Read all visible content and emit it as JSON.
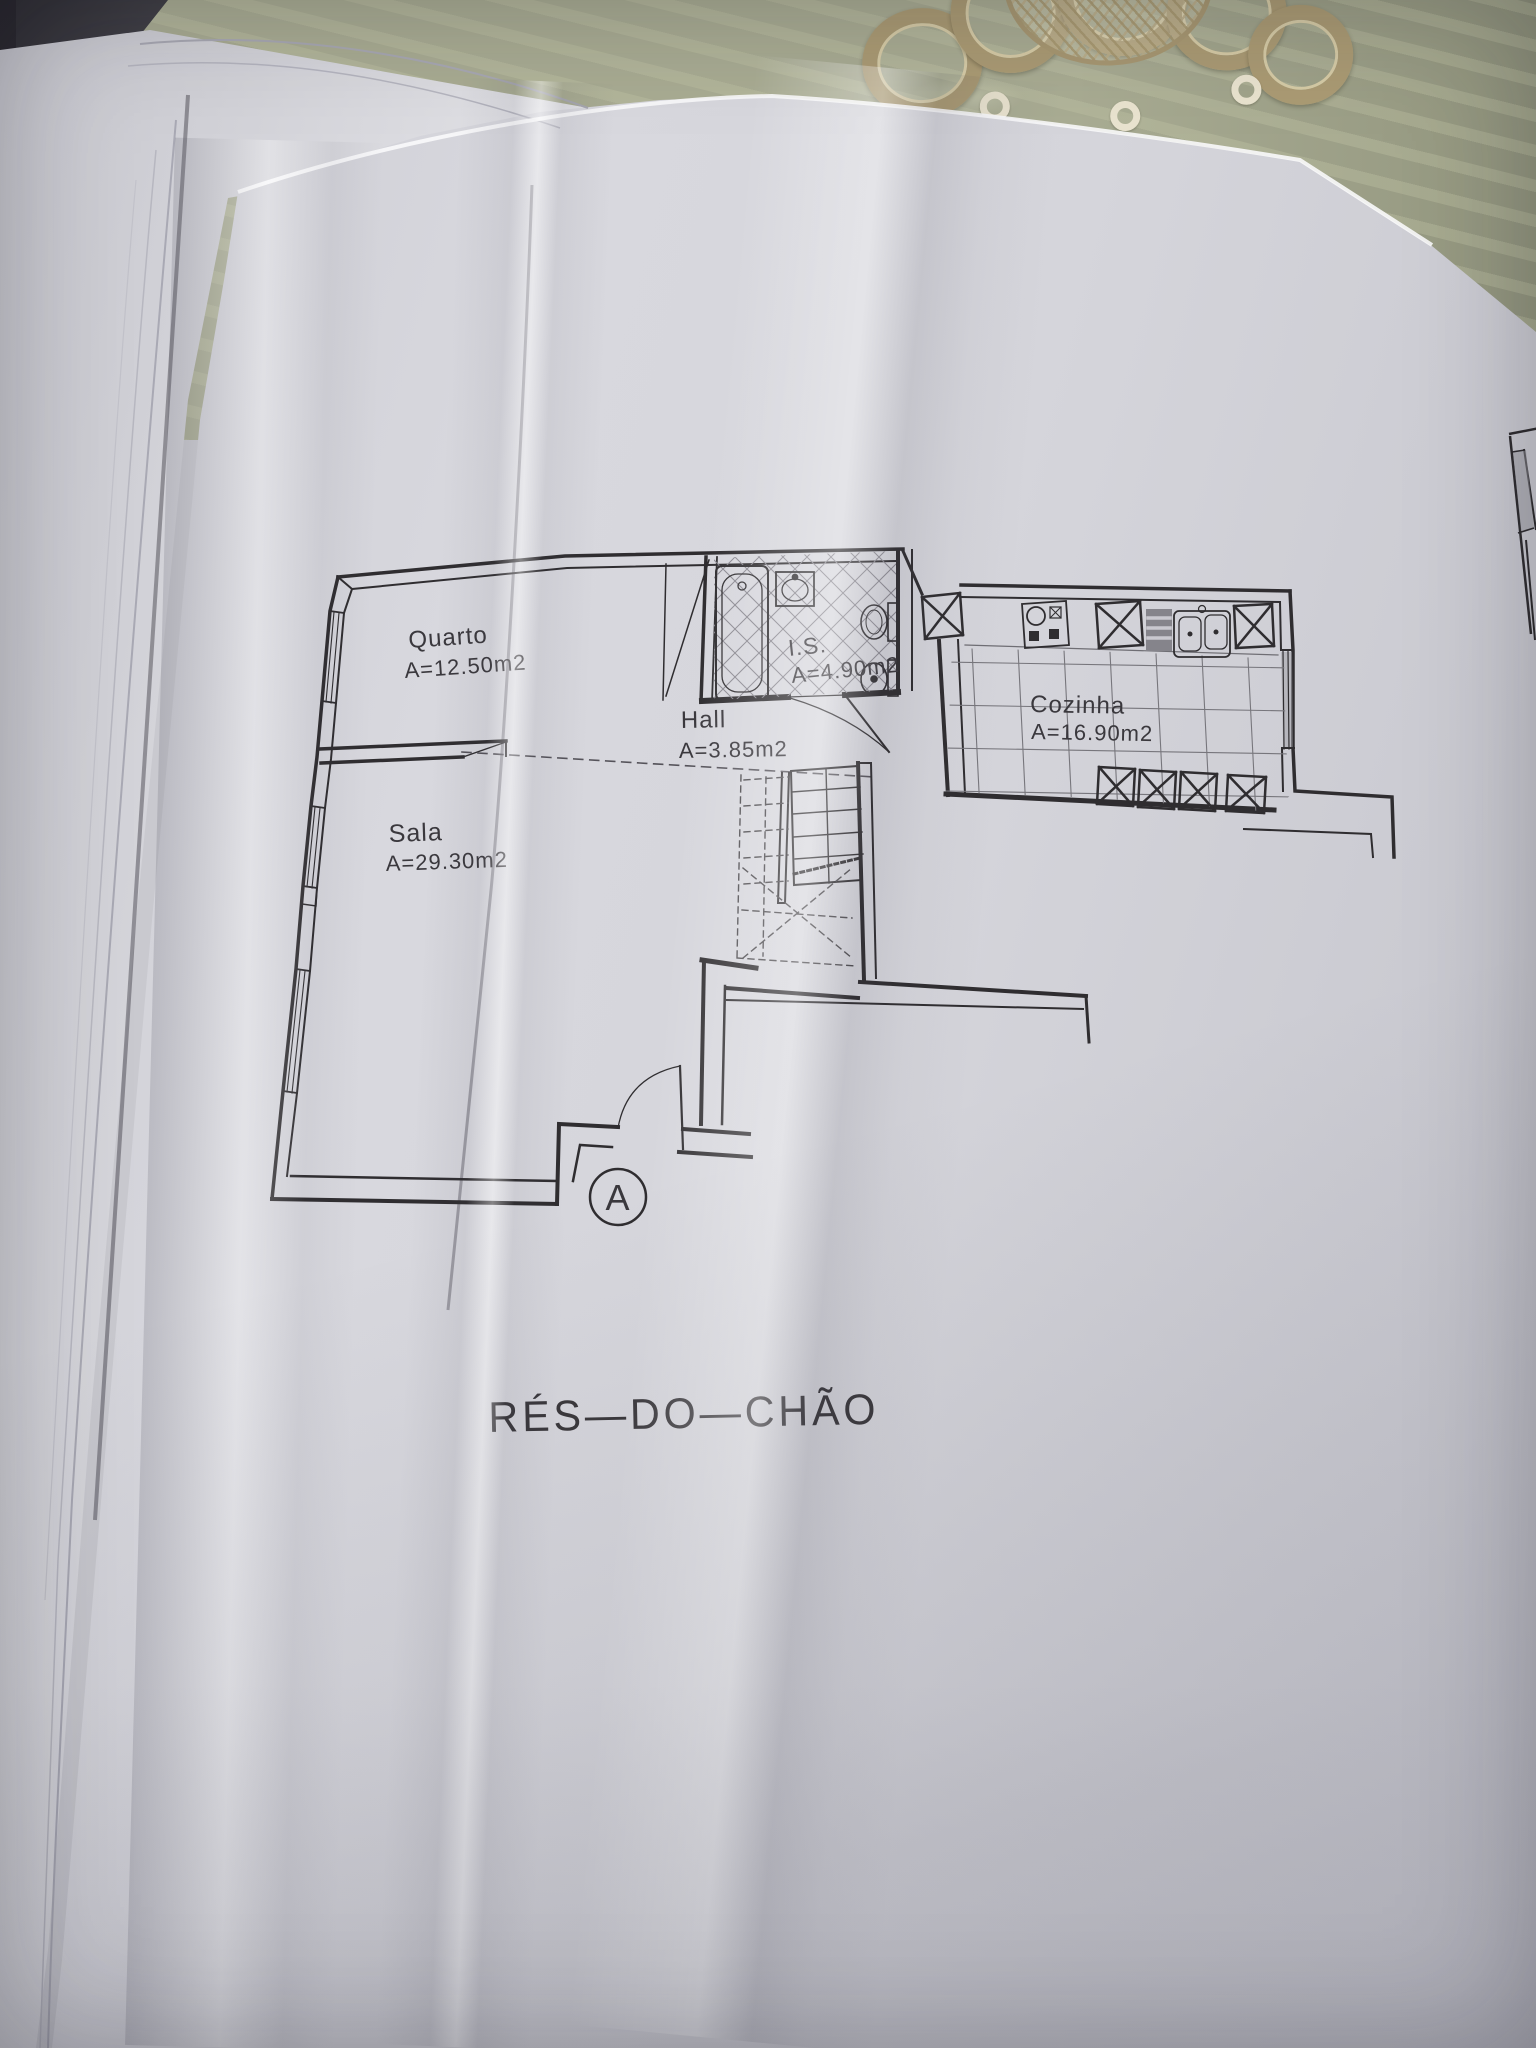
{
  "plan": {
    "title": "RÉS—DO—CHÃO",
    "section_marker": "A",
    "rooms": [
      {
        "name": "Quarto",
        "area": "A=12.50m2"
      },
      {
        "name": "Sala",
        "area": "A=29.30m2"
      },
      {
        "name": "Hall",
        "area": "A=3.85m2"
      },
      {
        "name": "I.S.",
        "area": "A=4.90m2"
      },
      {
        "name": "Cozinha",
        "area": "A=16.90m2"
      }
    ]
  },
  "colors": {
    "ink": "#2f2d30",
    "paper": "#d6d6dc",
    "tablecloth": "#a9ac93",
    "doily": "#ab9b74"
  }
}
